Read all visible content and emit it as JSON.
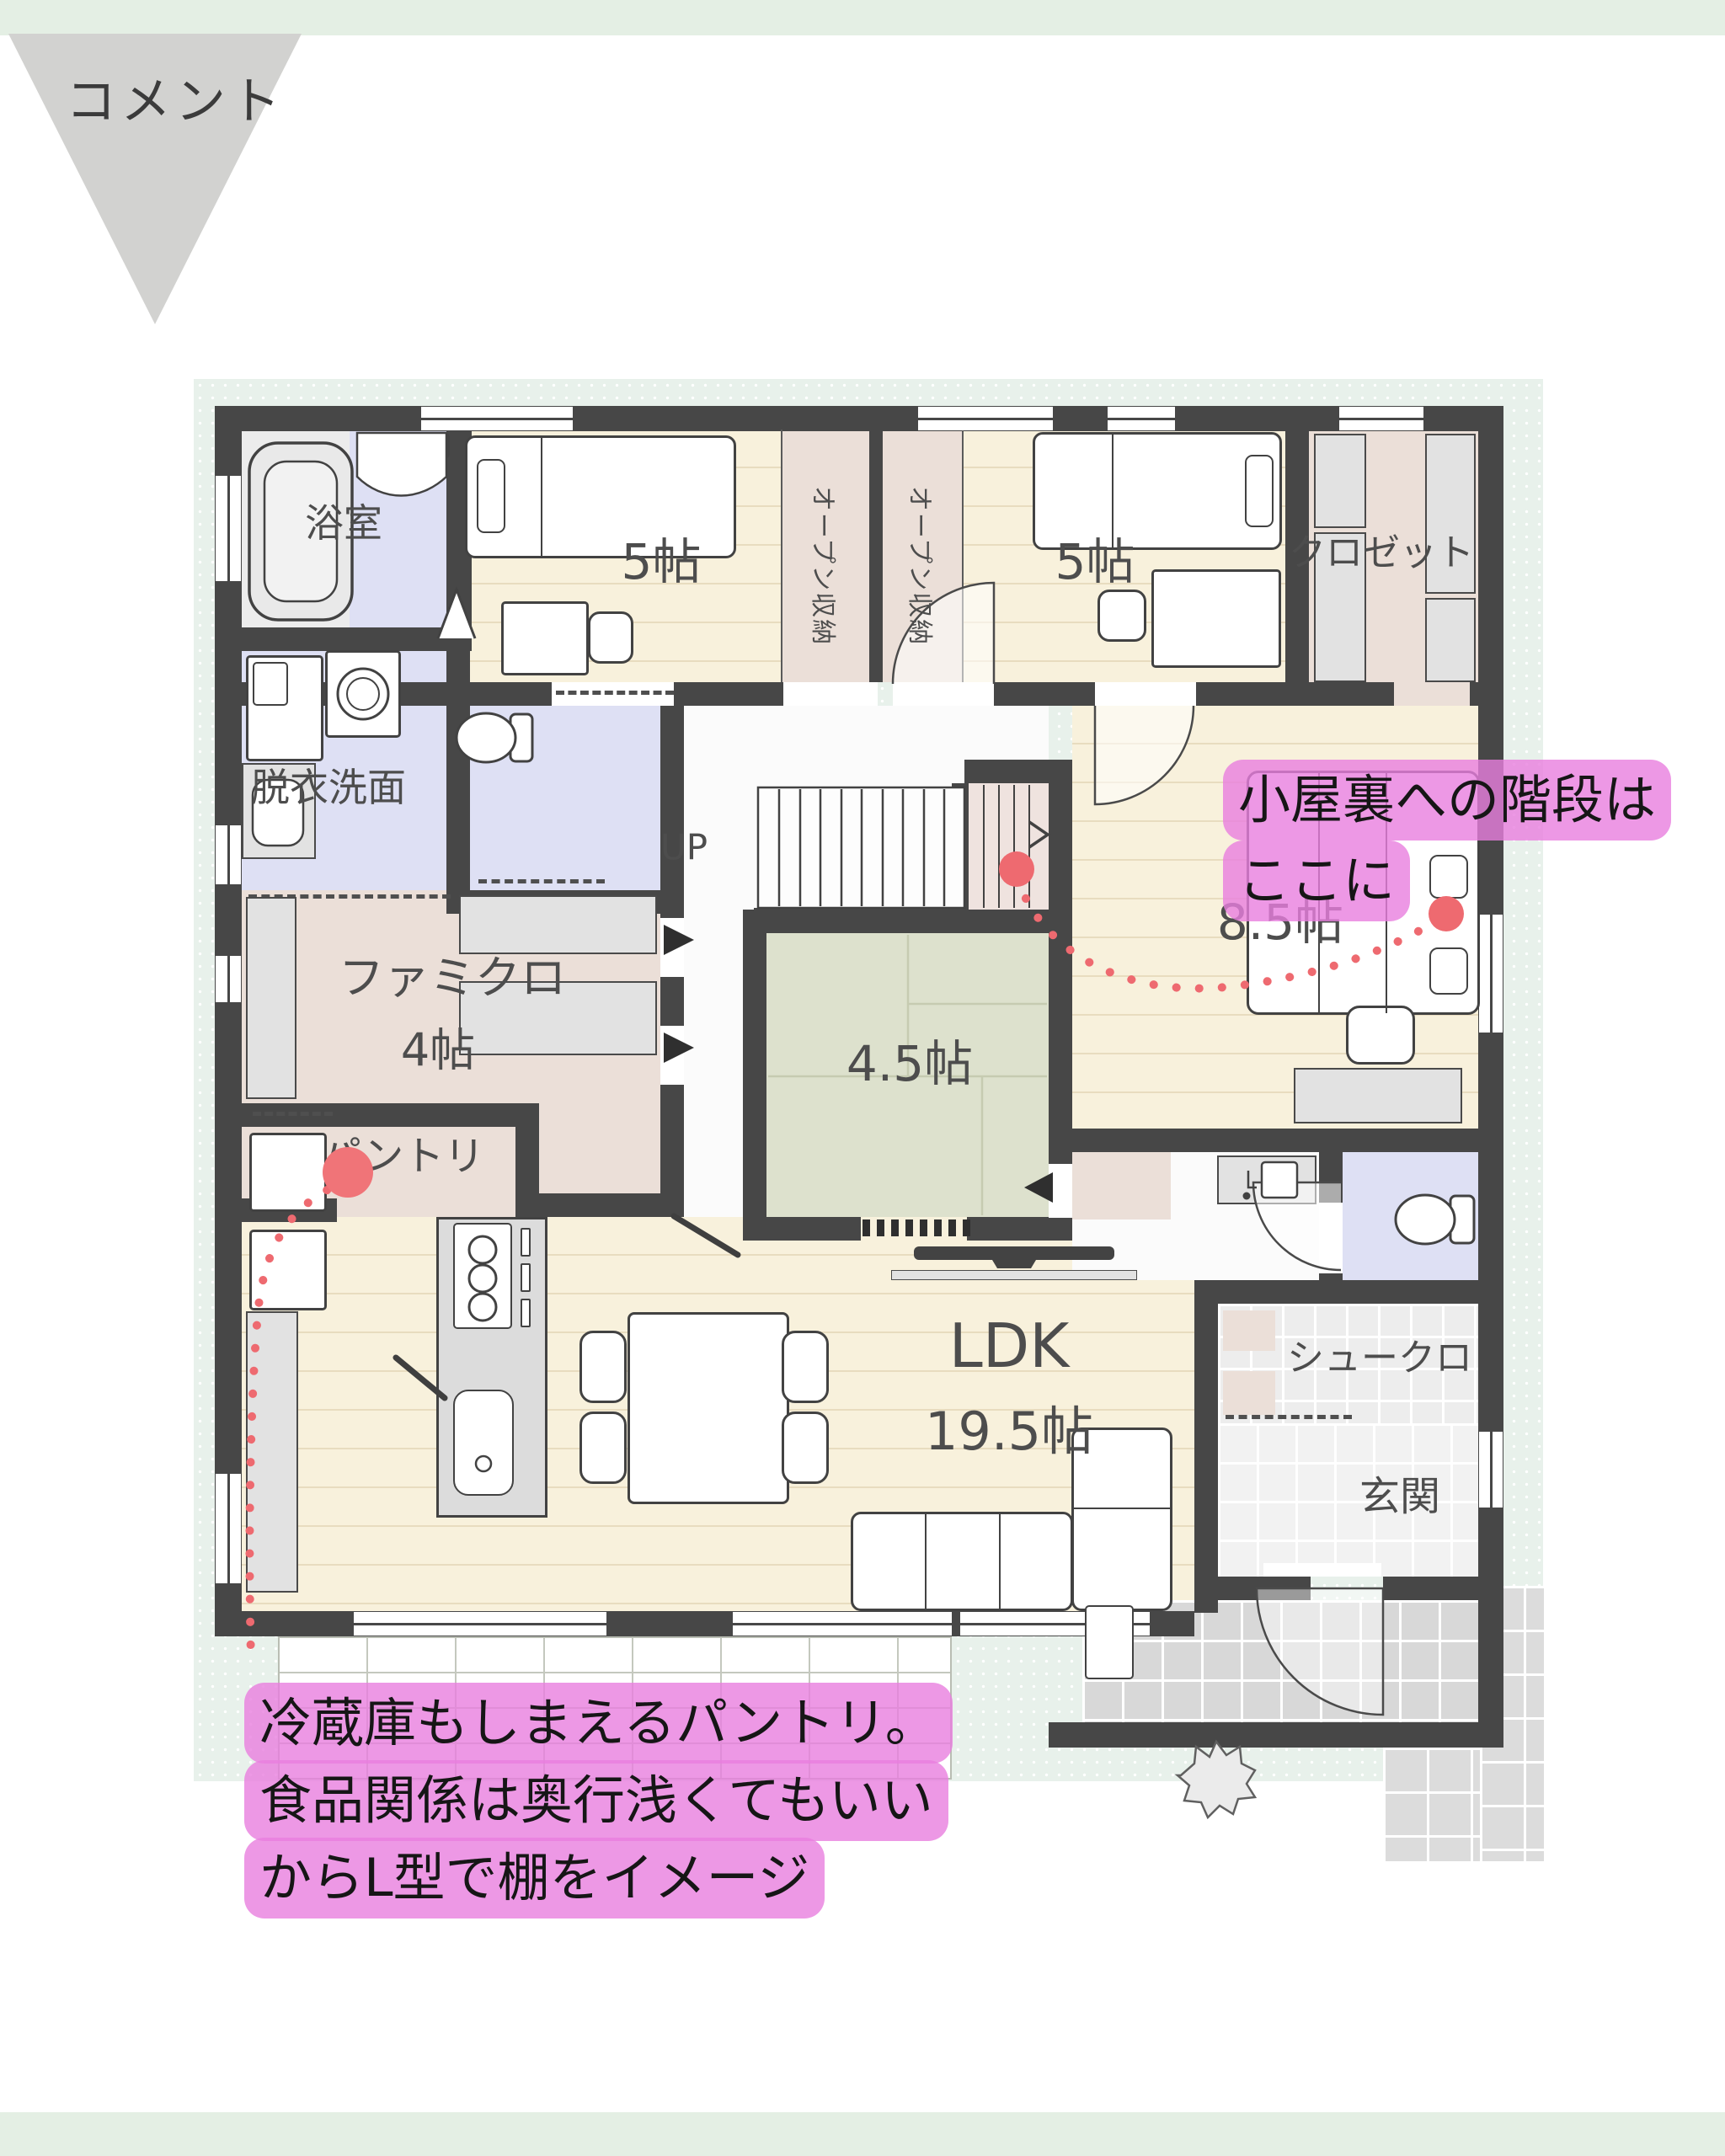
{
  "page": {
    "top_label": "コメント"
  },
  "floorplan": {
    "rooms": {
      "bath": {
        "label": "浴室"
      },
      "bedroom1": {
        "label": "5帖"
      },
      "open_storage_1": {
        "label": "オープン収納"
      },
      "open_storage_2": {
        "label": "オープン収納"
      },
      "bedroom2": {
        "label": "5帖"
      },
      "closet": {
        "label": "クロゼット"
      },
      "washroom": {
        "label": "脱衣洗面"
      },
      "stairs": {
        "label": "UP"
      },
      "famiclo": {
        "label": "ファミクロ",
        "size": "4帖"
      },
      "pantry": {
        "label": "パントリ"
      },
      "tatami": {
        "label": "4.5帖"
      },
      "bedroom3": {
        "label": "8.5帖"
      },
      "ldk": {
        "label": "LDK",
        "size": "19.5帖"
      },
      "shoe_closet": {
        "label": "シュークロ"
      },
      "entrance": {
        "label": "玄関"
      }
    }
  },
  "annotations": {
    "attic_stairs": {
      "line1": "小屋裏への階段は",
      "line2": "ここに"
    },
    "pantry_note": {
      "line1": "冷蔵庫もしまえるパントリ。",
      "line2": "食品関係は奥行浅くてもいい",
      "line3": "からL型で棚をイメージ"
    }
  },
  "colors": {
    "annotation_highlight": "#e87ee0",
    "marker_red": "#ee6a70",
    "wall": "#474747",
    "floor_wood": "#f8f1dc",
    "floor_tatami": "#dde1cd",
    "floor_storage": "#ebdfd8",
    "floor_wet": "#dee0f4",
    "background_mint": "#e8f1eb",
    "banner_green": "#e4efe4",
    "flag_gray": "#d2d2d0"
  }
}
